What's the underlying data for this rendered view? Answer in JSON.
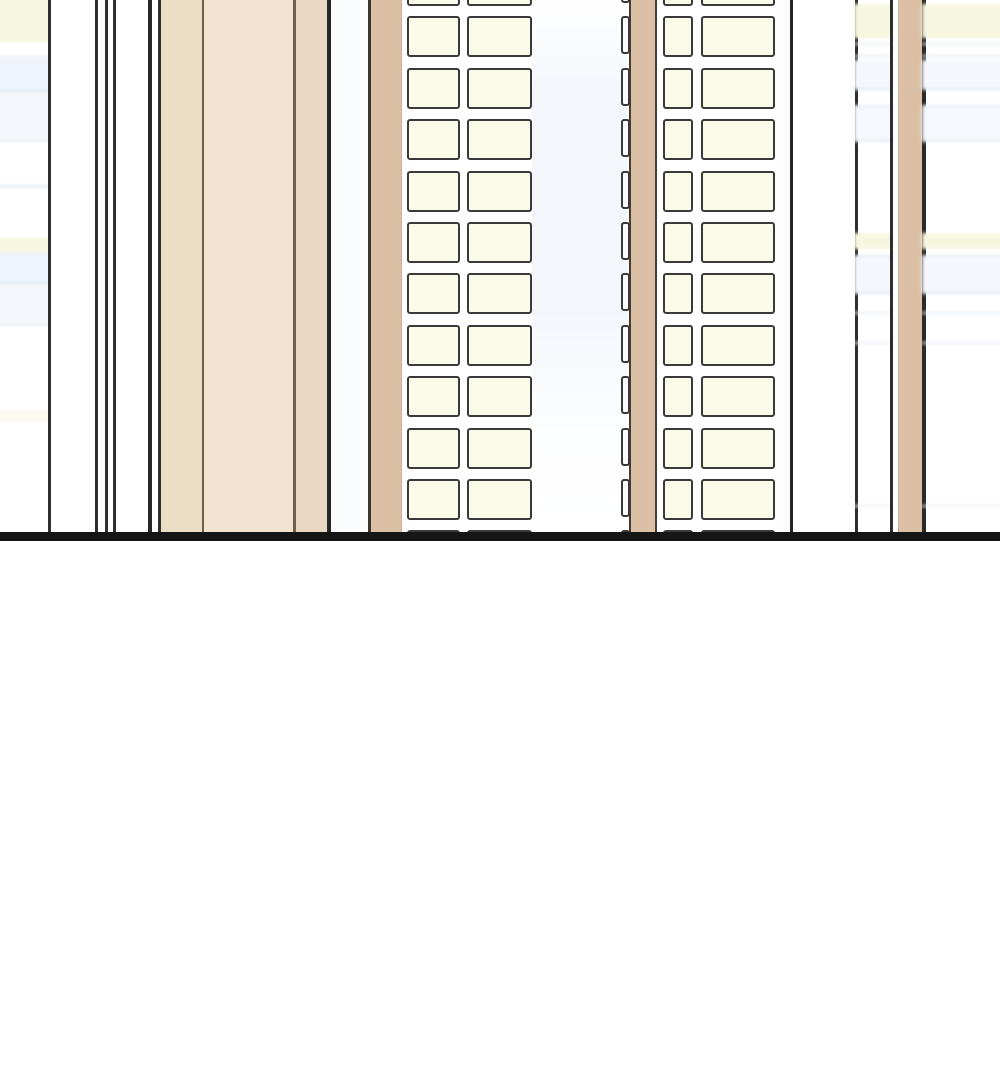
{
  "scene": {
    "width": 1000,
    "height": 1080,
    "description_colors": {
      "sky_base": "#ffffff",
      "sky_tint": "#f3f7fc",
      "window_outline": "#3a3a3a",
      "window_fill": "#fafbe9",
      "side_window_fill": "#fdfdfd",
      "pillar_tan": "#dcc0a5",
      "block_tan_left": "#eeddc5",
      "block_tan_mid": "#f2e2cf",
      "block_tan_right": "#ebd7c2",
      "edge_dark": "#2e2e2e",
      "ground_black": "#151515",
      "band_yellow": "#f7f7e0",
      "band_blue": "#e3eaf2"
    },
    "ground_line": {
      "y": 532,
      "height": 9,
      "color": "#151515"
    },
    "below_ground": {
      "top": 541,
      "color": "#ffffff"
    },
    "stripes": [
      {
        "name": "bg-building-far-left",
        "x": 0,
        "w": 48,
        "fill": "#ffffff",
        "bands": "left"
      },
      {
        "name": "building-edge-line",
        "x": 48,
        "w": 3,
        "fill": "#2e2e2e"
      },
      {
        "name": "facade-white-stripe",
        "x": 51,
        "w": 44,
        "fill": "#ffffff"
      },
      {
        "name": "building-edge-line",
        "x": 95,
        "w": 3,
        "fill": "#2e2e2e"
      },
      {
        "name": "facade-white-stripe",
        "x": 98,
        "w": 7,
        "fill": "#ffffff"
      },
      {
        "name": "building-edge-line",
        "x": 105,
        "w": 3,
        "fill": "#2e2e2e"
      },
      {
        "name": "facade-white-stripe",
        "x": 108,
        "w": 5,
        "fill": "#ffffff"
      },
      {
        "name": "building-edge-line",
        "x": 113,
        "w": 3,
        "fill": "#2e2e2e"
      },
      {
        "name": "facade-white-stripe",
        "x": 116,
        "w": 32,
        "fill": "#ffffff"
      },
      {
        "name": "building-edge-line",
        "x": 148,
        "w": 4,
        "fill": "#262626"
      },
      {
        "name": "facade-white-stripe",
        "x": 152,
        "w": 6,
        "fill": "#ffffff"
      },
      {
        "name": "building-edge-line",
        "x": 158,
        "w": 3,
        "fill": "#2e2e2e"
      },
      {
        "name": "tan-block-panel",
        "x": 161,
        "w": 41,
        "fill": "#eeddc5"
      },
      {
        "name": "panel-divider-line",
        "x": 202,
        "w": 2,
        "fill": "#6f6152"
      },
      {
        "name": "tan-block-panel",
        "x": 204,
        "w": 89,
        "fill": "#f2e2cf"
      },
      {
        "name": "panel-divider-line",
        "x": 293,
        "w": 3,
        "fill": "#6f6152"
      },
      {
        "name": "tan-block-panel",
        "x": 296,
        "w": 31,
        "fill": "#ebd7c2"
      },
      {
        "name": "building-edge-line",
        "x": 327,
        "w": 4,
        "fill": "#262626"
      },
      {
        "name": "facade-tinted-stripe",
        "x": 331,
        "w": 37,
        "fill": "#fafcfe"
      },
      {
        "name": "building-edge-line",
        "x": 368,
        "w": 3,
        "fill": "#3a342c"
      },
      {
        "name": "tan-pillar",
        "x": 371,
        "w": 30,
        "fill": "#dcc0a5"
      },
      {
        "name": "pillar-soft-edge",
        "x": 401,
        "w": 1,
        "fill": "#c8b299"
      },
      {
        "name": "facade-white-stripe",
        "x": 402,
        "w": 130,
        "fill": "#ffffff"
      },
      {
        "name": "facade-sky-gap",
        "x": 532,
        "w": 99,
        "tinted": true
      },
      {
        "name": "building-edge-line",
        "x": 629,
        "w": 2,
        "fill": "#453d33"
      },
      {
        "name": "tan-pillar",
        "x": 631,
        "w": 24,
        "fill": "#dcc0a5"
      },
      {
        "name": "building-edge-line",
        "x": 655,
        "w": 2,
        "fill": "#453d33"
      },
      {
        "name": "facade-white-stripe",
        "x": 657,
        "w": 6,
        "fill": "#ffffff"
      },
      {
        "name": "facade-white-stripe",
        "x": 663,
        "w": 112,
        "fill": "#ffffff"
      },
      {
        "name": "facade-white-stripe",
        "x": 775,
        "w": 15,
        "fill": "#fdfdfe"
      },
      {
        "name": "building-edge-line",
        "x": 790,
        "w": 3,
        "fill": "#262626"
      },
      {
        "name": "facade-white-stripe",
        "x": 793,
        "w": 62,
        "fill": "#ffffff"
      },
      {
        "name": "building-edge-line",
        "x": 855,
        "w": 3,
        "fill": "#2e2e2e"
      },
      {
        "name": "bg-building-right-slice",
        "x": 858,
        "w": 32,
        "fill": "#ffffff",
        "bands": "right"
      },
      {
        "name": "building-edge-line",
        "x": 890,
        "w": 3,
        "fill": "#2e2e2e"
      },
      {
        "name": "facade-white-stripe",
        "x": 893,
        "w": 6,
        "fill": "#ffffff"
      },
      {
        "name": "pillar-soft-edge",
        "x": 898,
        "w": 1,
        "fill": "#c8b299"
      },
      {
        "name": "tan-pillar",
        "x": 899,
        "w": 23,
        "fill": "#dcc0a5"
      },
      {
        "name": "building-edge-line",
        "x": 922,
        "w": 4,
        "fill": "#2a2a2a"
      },
      {
        "name": "bg-building-far-right",
        "x": 926,
        "w": 74,
        "fill": "#ffffff",
        "bands": "right"
      }
    ],
    "bands": {
      "left": [
        {
          "y": -6,
          "h": 48,
          "c": "#f7f7e0"
        },
        {
          "y": 56,
          "h": 34,
          "c": "#eff4fa"
        },
        {
          "y": 90,
          "h": 2,
          "c": "#dce4ef"
        },
        {
          "y": 92,
          "h": 48,
          "c": "#f3f7fb"
        },
        {
          "y": 140,
          "h": 2,
          "c": "#e4ebf4"
        },
        {
          "y": 185,
          "h": 3,
          "c": "#e9eef5"
        },
        {
          "y": 238,
          "h": 14,
          "c": "#f7f7e0"
        },
        {
          "y": 252,
          "h": 30,
          "c": "#eff4fa"
        },
        {
          "y": 282,
          "h": 2,
          "c": "#dce4ef"
        },
        {
          "y": 284,
          "h": 40,
          "c": "#f3f7fb"
        },
        {
          "y": 324,
          "h": 2,
          "c": "#e4ebf4"
        },
        {
          "y": 410,
          "h": 12,
          "c": "#fafaf0"
        }
      ],
      "right": [
        {
          "y": 4,
          "h": 34,
          "c": "#f7f7e0"
        },
        {
          "y": 43,
          "h": 2,
          "c": "#e9eef4"
        },
        {
          "y": 55,
          "h": 2,
          "c": "#e3eaf2"
        },
        {
          "y": 60,
          "h": 28,
          "c": "#f4f8fc"
        },
        {
          "y": 88,
          "h": 2,
          "c": "#dfe7f1"
        },
        {
          "y": 105,
          "h": 2,
          "c": "#e7edf4"
        },
        {
          "y": 107,
          "h": 33,
          "c": "#f5f8fc"
        },
        {
          "y": 140,
          "h": 2,
          "c": "#e5ecf4"
        },
        {
          "y": 233,
          "h": 16,
          "c": "#f7f7e0"
        },
        {
          "y": 255,
          "h": 2,
          "c": "#e3eaf2"
        },
        {
          "y": 257,
          "h": 35,
          "c": "#f4f8fc"
        },
        {
          "y": 292,
          "h": 2,
          "c": "#dfe7f1"
        },
        {
          "y": 312,
          "h": 2,
          "c": "#e7edf4"
        },
        {
          "y": 342,
          "h": 2,
          "c": "#eaeff6"
        },
        {
          "y": 505,
          "h": 2,
          "c": "#eef2f8"
        }
      ]
    },
    "row_grid": {
      "start": -35,
      "pitch": 51.4,
      "height": 41,
      "count": 12
    },
    "window_columns": [
      {
        "name": "left-tower-window-col-narrow",
        "x": 407,
        "w": 53,
        "fill": "#fafbe9"
      },
      {
        "name": "left-tower-window-col-wide",
        "x": 467,
        "w": 65,
        "fill": "#fafbe9"
      },
      {
        "name": "right-tower-side-window-col",
        "x": 621,
        "w": 9,
        "fill": "#fdfdfd",
        "height": 38
      },
      {
        "name": "right-tower-window-col-narrow",
        "x": 663,
        "w": 30,
        "fill": "#fafbe9"
      },
      {
        "name": "right-tower-window-col-wide",
        "x": 701,
        "w": 74,
        "fill": "#fafbe9"
      }
    ]
  }
}
